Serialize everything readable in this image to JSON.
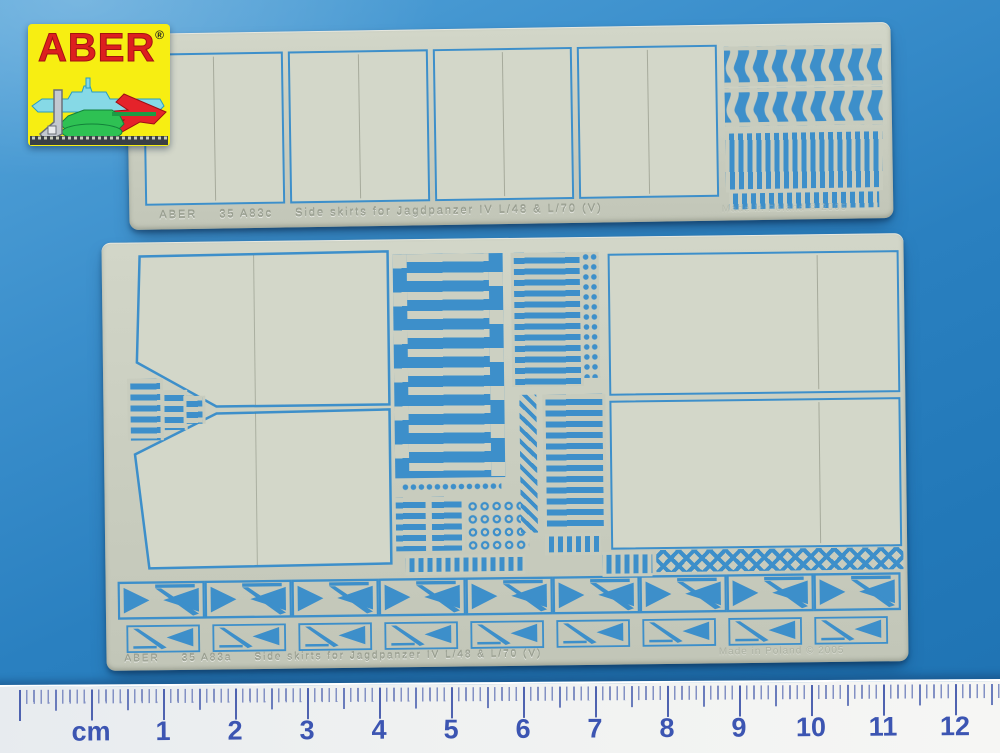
{
  "logo": {
    "brand": "ABER",
    "registered": "®"
  },
  "top_fret": {
    "brand": "ABER",
    "code": "35 A83c",
    "title": "Side skirts for Jagdpanzer IV L/48 & L/70 (V)",
    "origin": "Made in Poland © 2005"
  },
  "bottom_fret": {
    "brand": "ABER",
    "code": "35 A83a",
    "title": "Side skirts for Jagdpanzer IV L/48 & L/70 (V)",
    "origin": "Made in Poland © 2005"
  },
  "ruler": {
    "unit": "cm",
    "numbers": [
      "1",
      "2",
      "3",
      "4",
      "5",
      "6",
      "7",
      "8",
      "9",
      "10",
      "11",
      "12"
    ]
  },
  "colors": {
    "background_blue": "#2a80c0",
    "fret_metal": "#c9cdbf",
    "etch_cutout_blue": "#3d8fca",
    "ruler_number_blue": "#3c55b2",
    "logo_background": "#f7ee12",
    "logo_text_red": "#dd1f1f"
  }
}
